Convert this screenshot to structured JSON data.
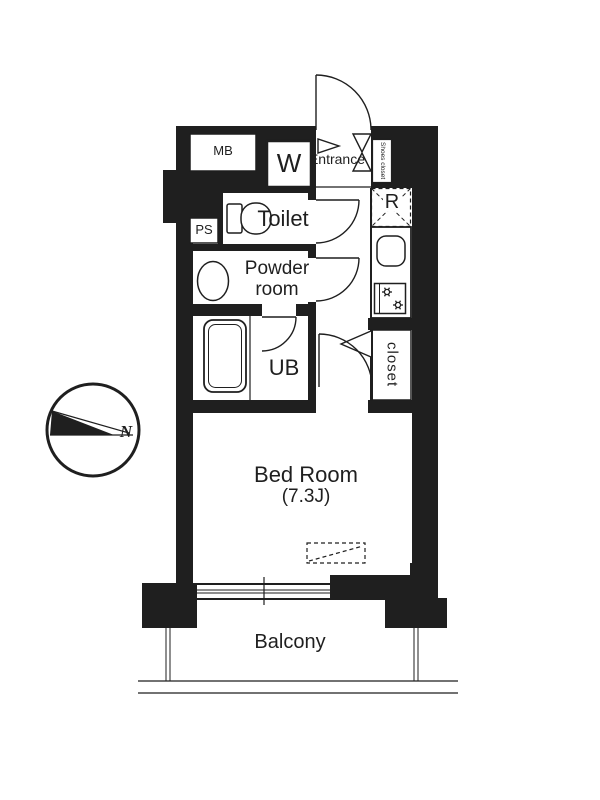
{
  "plan": {
    "labels": {
      "meter_box": "MB",
      "washer": "W",
      "entrance": "Entrance",
      "shoes_closet": "Shoes closet",
      "pipe_space": "PS",
      "toilet": "Toilet",
      "powder_room": "Powder\nroom",
      "refrigerator": "R",
      "unit_bath": "UB",
      "closet": "closet",
      "bedroom_name": "Bed Room",
      "bedroom_size": "(7.3J)",
      "balcony": "Balcony",
      "compass_north": "N"
    },
    "colors": {
      "ink": "#1f1f1f",
      "background": "#ffffff"
    }
  }
}
